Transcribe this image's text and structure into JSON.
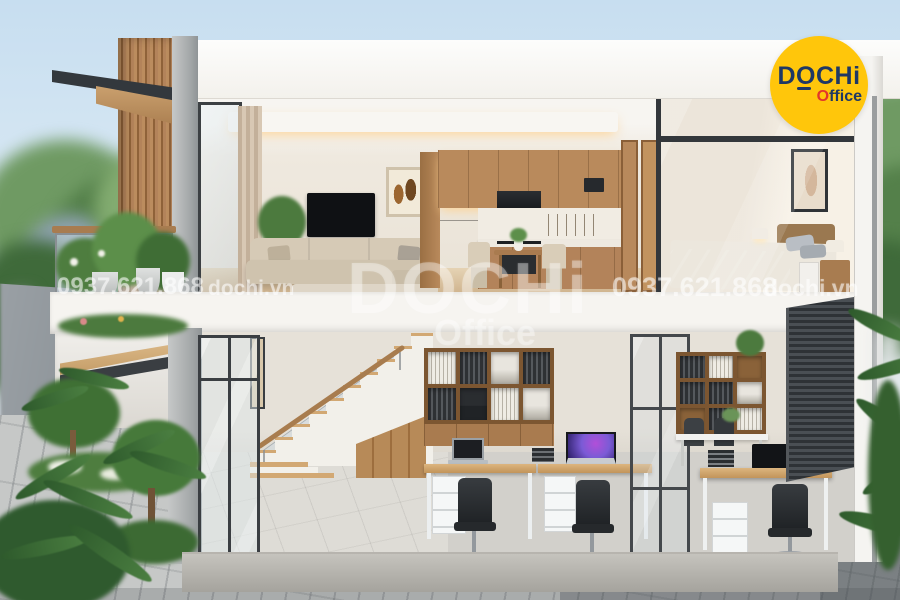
{
  "watermarks": {
    "phone_left": "0937.621.868",
    "site_left": "dochi.vn",
    "phone_right": "0937.621.868",
    "site_right": "dochi.vn",
    "center": {
      "brand": "DOCHi",
      "sub": "Office"
    }
  },
  "logo": {
    "brand": "DOCHi",
    "office_o": "O",
    "office_rest": "ffice",
    "colors": {
      "circle": "#FFC60B",
      "navy": "#1F3864",
      "red": "#E2362B"
    }
  },
  "palette": {
    "sky": "#C7DEF0",
    "wood": "#B98A5C",
    "concrete": "#AEB2B3",
    "wall_white": "#F6F4F0",
    "foliage": "#4C7A3E",
    "blinds_dark": "#3A3E42"
  }
}
